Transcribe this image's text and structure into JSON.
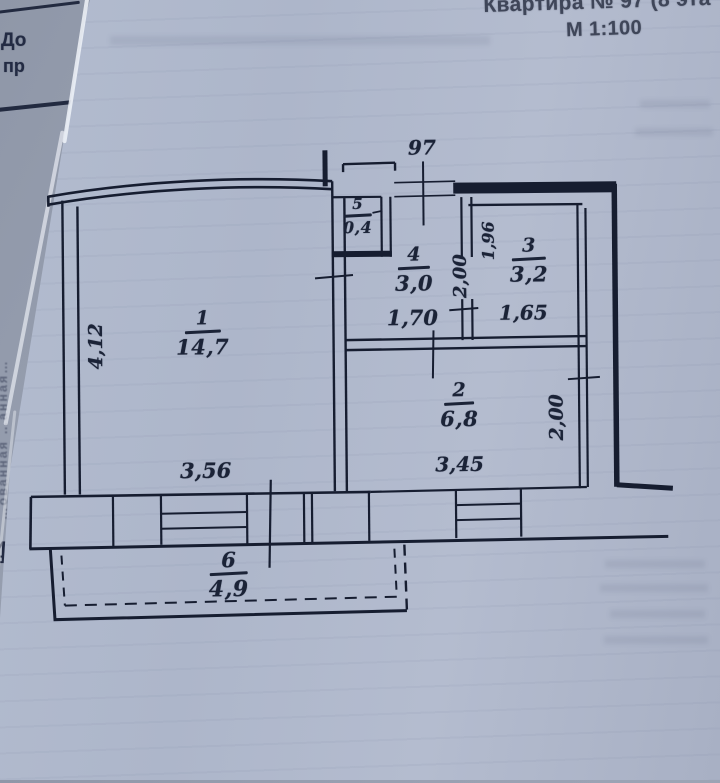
{
  "photo": {
    "title_line1": "Квартира № 97 (8 эта",
    "title_line2": "М 1:100"
  },
  "underlying_sheet": {
    "fragment_line1": "До",
    "fragment_line2": "пр",
    "fragment_number": "4",
    "side_rotated_text": "…ованная   …анная…"
  },
  "plan": {
    "rooms": [
      {
        "number": "1",
        "area": "14,7"
      },
      {
        "number": "2",
        "area": "6,8"
      },
      {
        "number": "3",
        "area": "3,2"
      },
      {
        "number": "4",
        "area": "3,0"
      },
      {
        "number": "5",
        "area": "0,4"
      },
      {
        "number": "6",
        "area": "4,9"
      }
    ],
    "dimensions": {
      "entry_width": "97",
      "room1_depth": "4,12",
      "room1_width": "3,56",
      "room4_width": "1,70",
      "room4_depth": "2,00",
      "room3_side": "1,96",
      "room3_width": "1,65",
      "room2_width": "3,45",
      "room2_depth": "2,00"
    },
    "colors": {
      "ink": "#161d30",
      "paper": "#b0b9cd"
    }
  }
}
